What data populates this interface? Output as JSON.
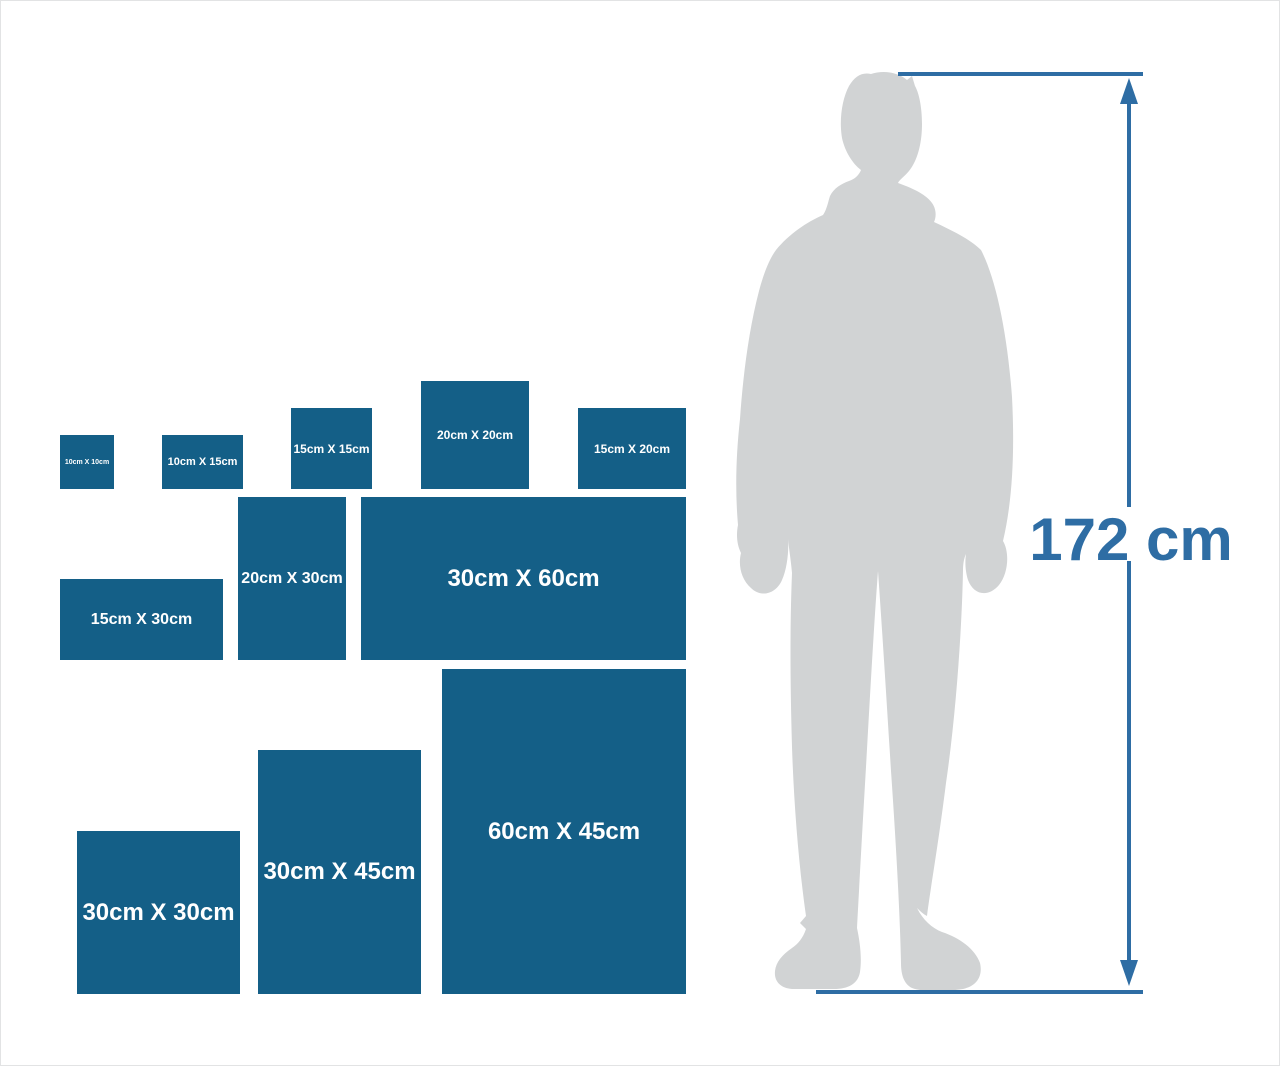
{
  "canvas": {
    "width": 1280,
    "height": 1066,
    "background": "#ffffff",
    "frame_color": "#e2e3e4"
  },
  "palette": {
    "box_blue": "#145f87",
    "label_white": "#ffffff",
    "measure_blue": "#2e6da4",
    "silhouette_gray": "#d1d3d4"
  },
  "scale": {
    "px_per_cm": 5.42
  },
  "size_boxes": [
    {
      "id": "10x10",
      "label": "10cm X 10cm",
      "w_cm": 10,
      "h_cm": 10,
      "x": 59,
      "baseline": 488,
      "label_px": 7
    },
    {
      "id": "10x15",
      "label": "10cm X 15cm",
      "w_cm": 15,
      "h_cm": 10,
      "x": 161,
      "baseline": 488,
      "label_px": 11
    },
    {
      "id": "15x15",
      "label": "15cm X 15cm",
      "w_cm": 15,
      "h_cm": 15,
      "x": 290,
      "baseline": 488,
      "label_px": 12
    },
    {
      "id": "20x20",
      "label": "20cm X 20cm",
      "w_cm": 20,
      "h_cm": 20,
      "x": 420,
      "baseline": 488,
      "label_px": 12
    },
    {
      "id": "15x20",
      "label": "15cm X 20cm",
      "w_cm": 20,
      "h_cm": 15,
      "x": 577,
      "baseline": 488,
      "label_px": 12
    },
    {
      "id": "15x30",
      "label": "15cm X 30cm",
      "w_cm": 30,
      "h_cm": 15,
      "x": 59,
      "baseline": 659,
      "label_px": 16
    },
    {
      "id": "20x30",
      "label": "20cm X 30cm",
      "w_cm": 20,
      "h_cm": 30,
      "x": 237,
      "baseline": 659,
      "label_px": 16
    },
    {
      "id": "30x60",
      "label": "30cm X 60cm",
      "w_cm": 60,
      "h_cm": 30,
      "x": 360,
      "baseline": 659,
      "label_px": 24
    },
    {
      "id": "30x30",
      "label": "30cm X 30cm",
      "w_cm": 30,
      "h_cm": 30,
      "x": 76,
      "baseline": 993,
      "label_px": 24
    },
    {
      "id": "30x45",
      "label": "30cm X 45cm",
      "w_cm": 30,
      "h_cm": 45,
      "x": 257,
      "baseline": 993,
      "label_px": 24
    },
    {
      "id": "60x45",
      "label": "60cm X 45cm",
      "w_cm": 45,
      "h_cm": 60,
      "x": 441,
      "baseline": 993,
      "label_px": 24
    }
  ],
  "measure": {
    "label": "172 cm"
  }
}
